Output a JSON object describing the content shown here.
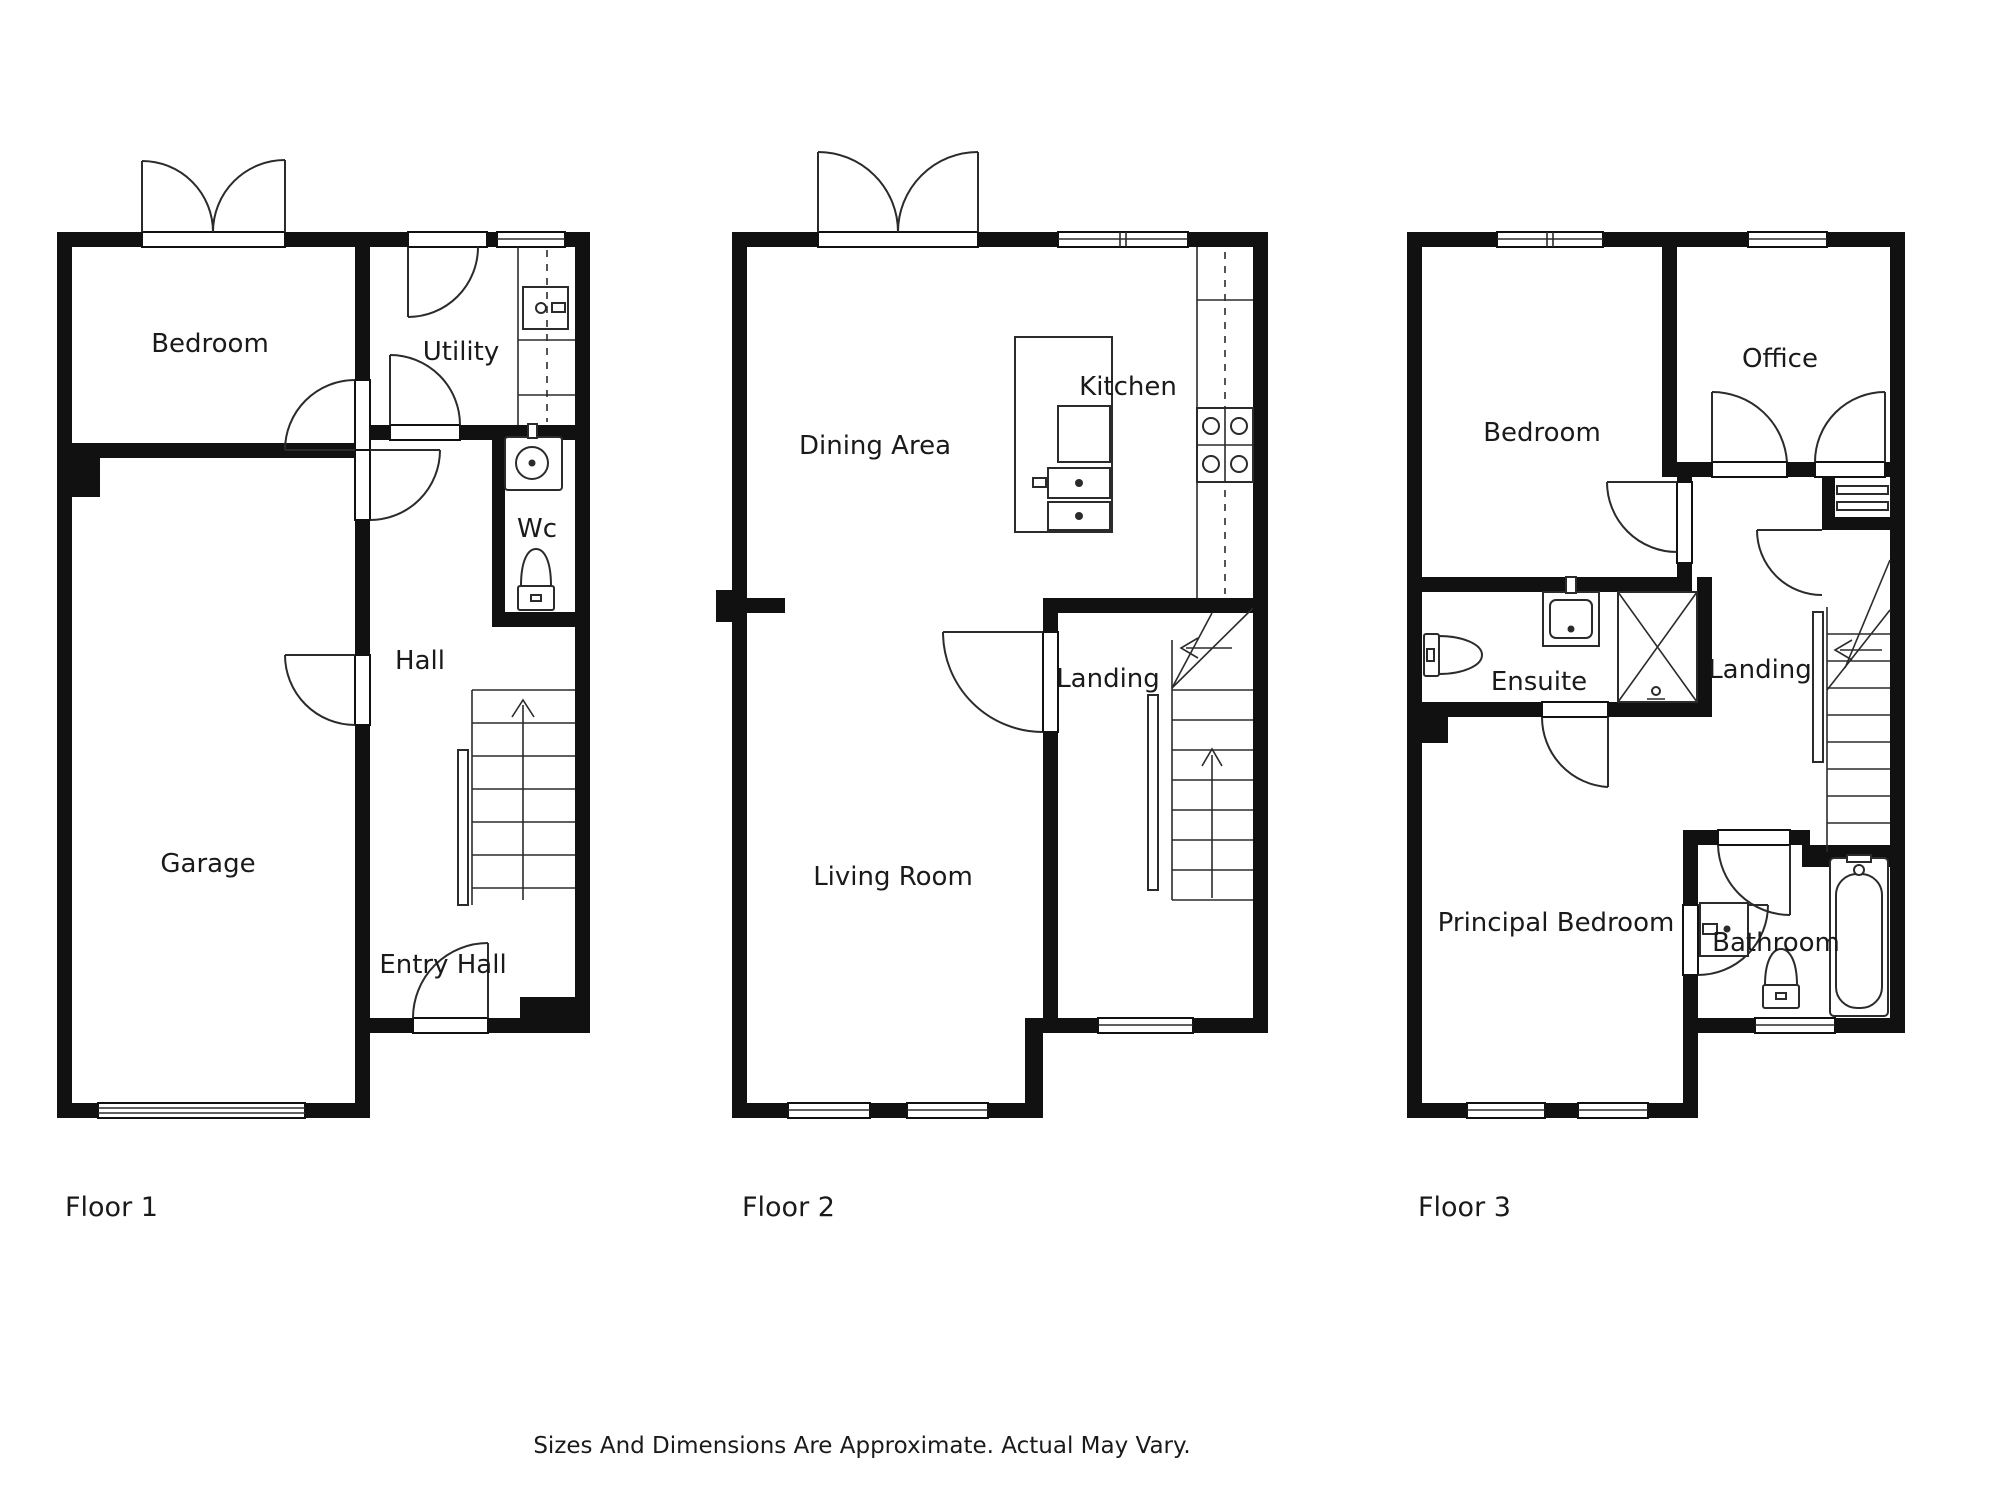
{
  "colors": {
    "wall": "#111111",
    "line": "#2b2b2b",
    "text": "#1a1a1a",
    "bg": "#ffffff"
  },
  "floors": [
    {
      "label": "Floor 1",
      "rooms": [
        {
          "label": "Bedroom"
        },
        {
          "label": "Utility"
        },
        {
          "label": "Wc"
        },
        {
          "label": "Hall"
        },
        {
          "label": "Garage"
        },
        {
          "label": "Entry Hall"
        }
      ]
    },
    {
      "label": "Floor 2",
      "rooms": [
        {
          "label": "Dining Area"
        },
        {
          "label": "Kitchen"
        },
        {
          "label": "Landing"
        },
        {
          "label": "Living Room"
        }
      ]
    },
    {
      "label": "Floor 3",
      "rooms": [
        {
          "label": "Bedroom"
        },
        {
          "label": "Office"
        },
        {
          "label": "Ensuite"
        },
        {
          "label": "Landing"
        },
        {
          "label": "Principal Bedroom"
        },
        {
          "label": "Bathroom"
        }
      ]
    }
  ],
  "disclaimer": "Sizes And Dimensions Are Approximate. Actual May Vary."
}
